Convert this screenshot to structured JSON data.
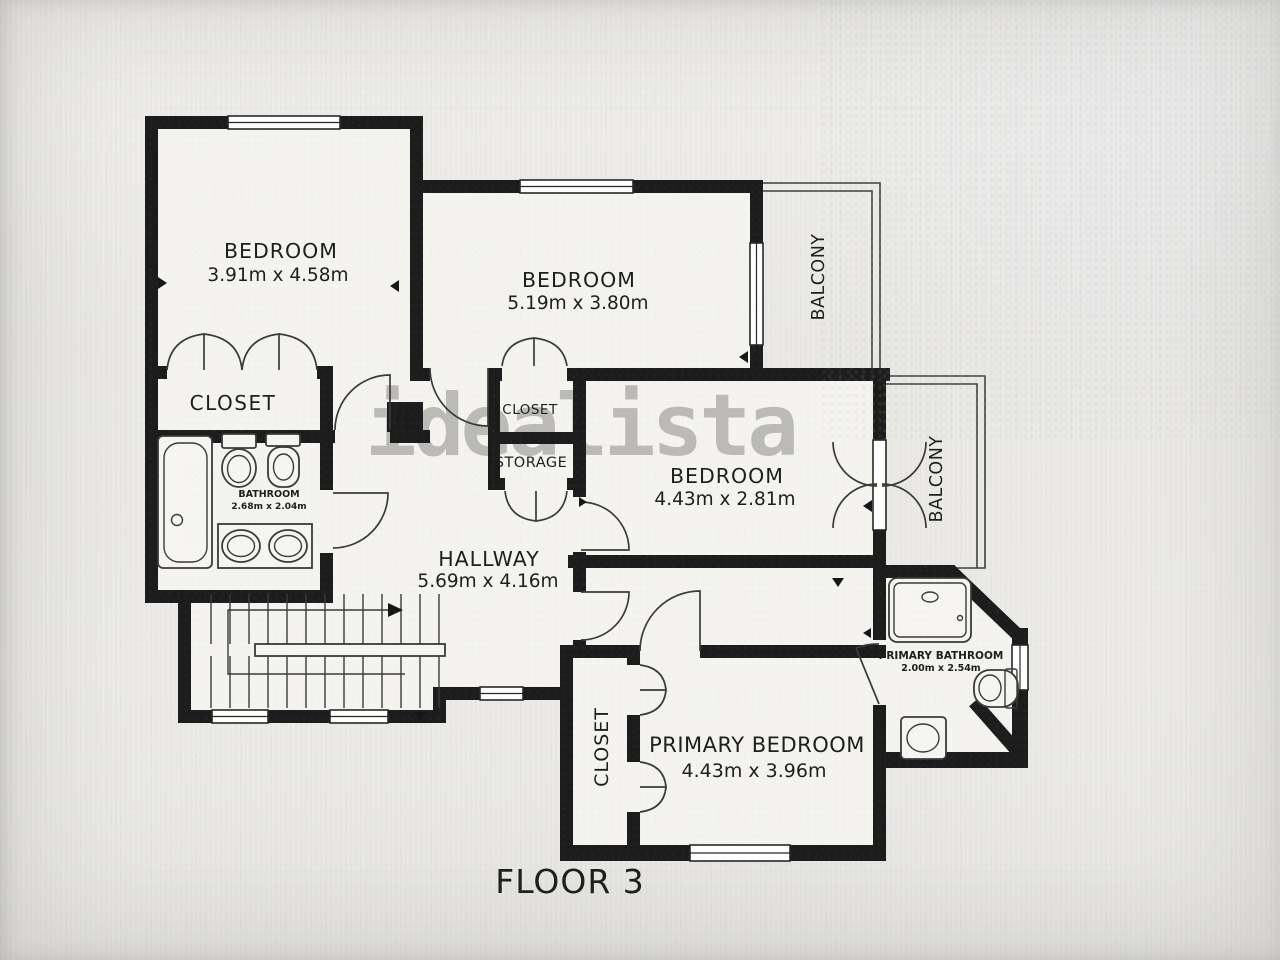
{
  "plan": {
    "floor_label": "FLOOR 3",
    "watermark": "idealista",
    "rooms": {
      "bedroom1": {
        "label": "BEDROOM",
        "dims": "3.91m x 4.58m"
      },
      "bedroom2": {
        "label": "BEDROOM",
        "dims": "5.19m x 3.80m"
      },
      "bedroom3": {
        "label": "BEDROOM",
        "dims": "4.43m x 2.81m"
      },
      "primary_bedroom": {
        "label": "PRIMARY BEDROOM",
        "dims": "4.43m x 3.96m"
      },
      "hallway": {
        "label": "HALLWAY",
        "dims": "5.69m x 4.16m"
      },
      "bathroom": {
        "label": "BATHROOM",
        "dims": "2.68m x 2.04m"
      },
      "primary_bathroom": {
        "label": "PRIMARY BATHROOM",
        "dims": "2.00m x 2.54m"
      },
      "closet_bedroom1": {
        "label": "CLOSET"
      },
      "closet_hall": {
        "label": "CLOSET"
      },
      "storage": {
        "label": "STORAGE"
      },
      "closet_primary": {
        "label": "CLOSET"
      },
      "balcony_top": {
        "label": "BALCONY"
      },
      "balcony_right": {
        "label": "BALCONY"
      }
    },
    "colors": {
      "wall": "#1c1c1c",
      "floor": "#f4f3ef",
      "background": "#eceae7",
      "watermark": "#8a8a86",
      "label_text": "#1d1d1c"
    }
  }
}
